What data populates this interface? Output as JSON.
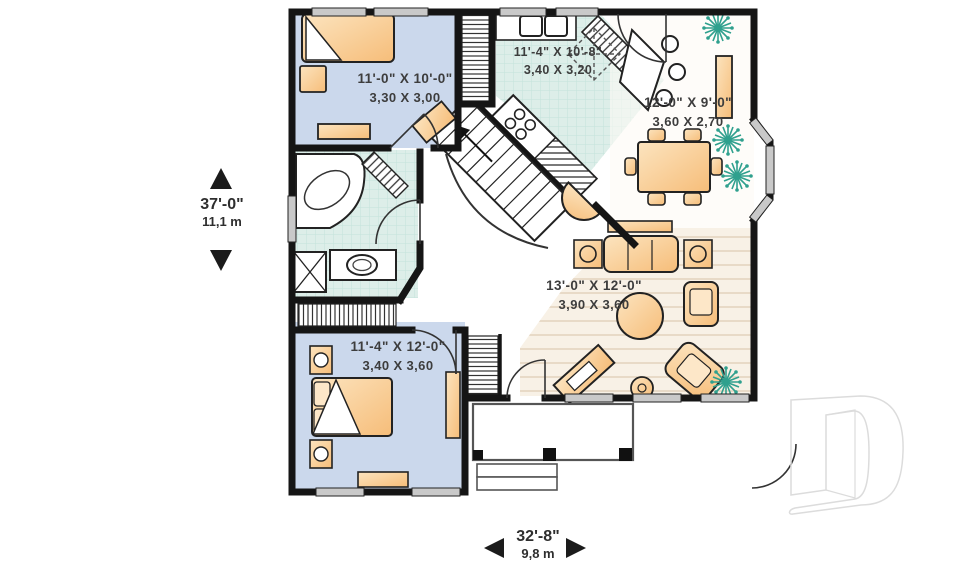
{
  "plan": {
    "rooms": [
      {
        "name": "bedroom-top",
        "imperial": "11'-0\" X 10'-0\"",
        "metric": "3,30 X 3,00"
      },
      {
        "name": "kitchen",
        "imperial": "11'-4\" X 10'-8\"",
        "metric": "3,40 X 3,20"
      },
      {
        "name": "dining",
        "imperial": "12'-0\" X 9'-0\"",
        "metric": "3,60 X 2,70"
      },
      {
        "name": "living",
        "imperial": "13'-0\" X 12'-0\"",
        "metric": "3,90 X 3,60"
      },
      {
        "name": "bedroom-bottom",
        "imperial": "11'-4\" X 12'-0\"",
        "metric": "3,40 X 3,60"
      }
    ],
    "dimensions": {
      "overall_depth": {
        "imperial": "37'-0\"",
        "metric": "11,1 m"
      },
      "overall_width": {
        "imperial": "32'-8\"",
        "metric": "9,8 m"
      }
    },
    "colors": {
      "wall": "#151515",
      "bedroom_floor": "#cbd8ec",
      "tile_floor": "#ddeee9",
      "wood_floor": "#f8f1e6",
      "furniture": "#f9d2a0",
      "plant": "#2fa08e",
      "window": "#c9c9c9",
      "watermark_outline": "#dcdcdc"
    },
    "watermark_letter": "D"
  }
}
